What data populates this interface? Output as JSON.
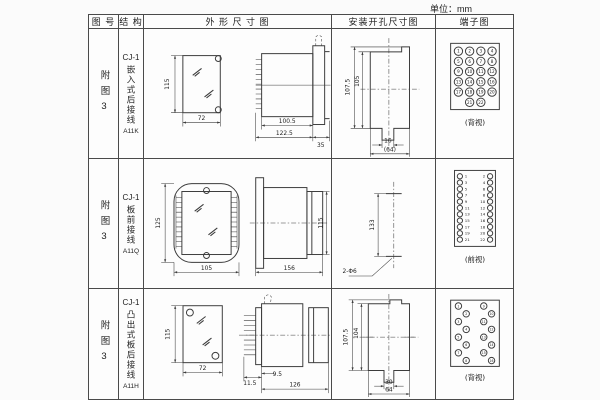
{
  "unit_label": "单位：mm",
  "colors": {
    "line": "#3c3c3c",
    "border": "#4a4a4a",
    "background": "#fbfbfb"
  },
  "table": {
    "headers": [
      "图 号",
      "结 构",
      "外 形 尺 寸 图",
      "安装开孔尺寸图",
      "端子图"
    ],
    "rows": [
      {
        "figure_no": "附图3",
        "structure": {
          "model": "CJ-1",
          "mounting": "嵌入式后接线",
          "code": "A11K"
        },
        "outline": {
          "height": "115",
          "width": "72",
          "body_depth": "100.5",
          "overall_depth": "122.5",
          "flange_depth": "35"
        },
        "install": {
          "outer_height": "107.5",
          "inner_height": "105",
          "slot_width": "16",
          "overall_width": "(64)"
        },
        "terminal": {
          "view": "(背视)",
          "layout": "grid",
          "count": 22
        }
      },
      {
        "figure_no": "附图3",
        "structure": {
          "model": "CJ-1",
          "mounting": "板前接线",
          "code": "A11Q"
        },
        "outline": {
          "height": "125",
          "width": "105",
          "depth": "156",
          "case_height": "115"
        },
        "install": {
          "hole_pitch": "133",
          "holes": "2-Φ6"
        },
        "terminal": {
          "view": "(前视)",
          "layout": "pairs",
          "count": 22
        }
      },
      {
        "figure_no": "附图3",
        "structure": {
          "model": "CJ-1",
          "mounting": "凸出式板后接线",
          "code": "A11H"
        },
        "outline": {
          "height": "115",
          "width": "72",
          "pin_depth": "11.5",
          "panel_offset": "9.5",
          "overall_depth": "126"
        },
        "install": {
          "outer_height": "107.5",
          "inner_height": "104",
          "slot_width": "30",
          "overall_width": "64"
        },
        "terminal": {
          "view": "(背视)",
          "layout": "staggered",
          "count": 16
        }
      }
    ]
  }
}
